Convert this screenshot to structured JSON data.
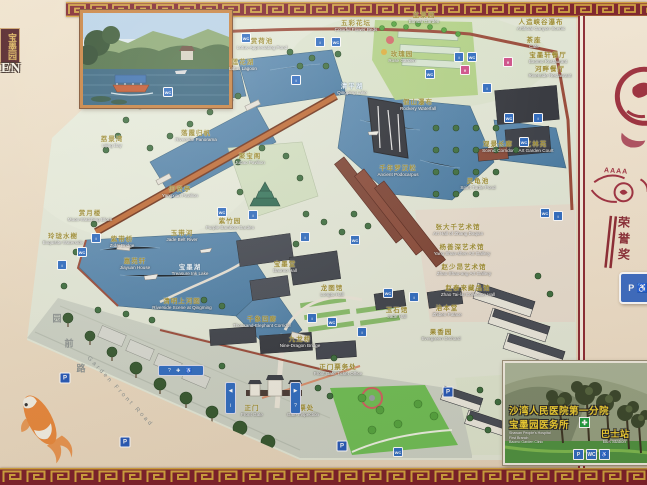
{
  "plaque": {
    "chars": "宝墨园",
    "latin": "EN"
  },
  "side_panel": {
    "stars": "AAAA",
    "vertical_chars": [
      "荣",
      "誉",
      "奖"
    ],
    "sign_glyphs": "P ♿"
  },
  "road": {
    "chars": [
      "园",
      "前",
      "路"
    ],
    "en": "Garden Front Road"
  },
  "colors": {
    "frame": "#7d1f28",
    "pattern_gold": "#d2a23c",
    "water": "#4f81a9",
    "mat": "#eedfc9",
    "accent_blue": "#2e6cc2"
  },
  "labels": [
    {
      "x": 262,
      "y": 45,
      "zh": "赏荷池",
      "en": "Lotus-Appreciating Pond"
    },
    {
      "x": 243,
      "y": 66,
      "zh": "莲花湖",
      "en": "Lotus Lagoon"
    },
    {
      "x": 356,
      "y": 27,
      "zh": "五彩花坛",
      "en": "Colorful Flower Beds"
    },
    {
      "x": 424,
      "y": 19,
      "zh": "盆景园",
      "en": "Bonsai Garden"
    },
    {
      "x": 541,
      "y": 26,
      "zh": "人造峡谷瀑布",
      "en": "Artificial Canyon Scenic"
    },
    {
      "x": 534,
      "y": 44,
      "zh": "茶座",
      "en": "Cafe"
    },
    {
      "x": 548,
      "y": 59,
      "zh": "宝墨轩餐厅",
      "en": "Baomo Restaurant"
    },
    {
      "x": 550,
      "y": 73,
      "zh": "河畔餐厅",
      "en": "Riverside Restaurant"
    },
    {
      "x": 402,
      "y": 58,
      "zh": "玫瑰园",
      "en": "Rose Garden"
    },
    {
      "x": 352,
      "y": 90,
      "zh": "清平湖",
      "en": "Qingping Lake",
      "w": 1
    },
    {
      "x": 112,
      "y": 143,
      "zh": "荔景湾",
      "en": "Lijing Bay"
    },
    {
      "x": 196,
      "y": 137,
      "zh": "落霞归帆",
      "en": "Riverside Panorama"
    },
    {
      "x": 180,
      "y": 193,
      "zh": "仰贤亭",
      "en": "Yangxian Pavilion"
    },
    {
      "x": 90,
      "y": 217,
      "zh": "赏月楼",
      "en": "Moon-Watching Block"
    },
    {
      "x": 63,
      "y": 240,
      "zh": "玲珑水榭",
      "en": "Exquisite Waterside"
    },
    {
      "x": 122,
      "y": 243,
      "zh": "紫带桥",
      "en": "Zidai Bridge"
    },
    {
      "x": 182,
      "y": 237,
      "zh": "玉带河",
      "en": "Jade Belt River"
    },
    {
      "x": 135,
      "y": 265,
      "zh": "嘉苑轩",
      "en": "Jiayuan House"
    },
    {
      "x": 190,
      "y": 271,
      "zh": "宝墨湖",
      "en": "Treasure Ink Lake",
      "w": 1
    },
    {
      "x": 182,
      "y": 305,
      "zh": "清明上河图",
      "en": "Riverside Scene at Qingming"
    },
    {
      "x": 230,
      "y": 225,
      "zh": "紫竹园",
      "en": "Purple Bamboo Garden"
    },
    {
      "x": 285,
      "y": 268,
      "zh": "宝墨堂",
      "en": "Baomo Hall"
    },
    {
      "x": 332,
      "y": 292,
      "zh": "龙图馆",
      "en": "Longtu Hall"
    },
    {
      "x": 262,
      "y": 323,
      "zh": "千象回廊",
      "en": "Thousand-Elephant Corridor"
    },
    {
      "x": 300,
      "y": 343,
      "zh": "九龙桥",
      "en": "Nine-Dragon Bridge"
    },
    {
      "x": 250,
      "y": 160,
      "zh": "聚宝阁",
      "en": "Jubao Pavilion"
    },
    {
      "x": 398,
      "y": 172,
      "zh": "千年罗汉松",
      "en": "Ancient Podocarpus"
    },
    {
      "x": 418,
      "y": 106,
      "zh": "假山瀑布",
      "en": "Rockery Waterfall"
    },
    {
      "x": 498,
      "y": 148,
      "zh": "观景长廊",
      "en": "Scenic Corridor"
    },
    {
      "x": 478,
      "y": 185,
      "zh": "灵龟池",
      "en": "Spirit Turtle Pond"
    },
    {
      "x": 536,
      "y": 148,
      "zh": "艺林苑",
      "en": "Art Garden Court"
    },
    {
      "x": 458,
      "y": 231,
      "zh": "张大千艺术馆",
      "en": "Art Hall of Zhang Daqian"
    },
    {
      "x": 462,
      "y": 251,
      "zh": "杨善深艺术馆",
      "en": "Yang Shan-shen Art Gallery"
    },
    {
      "x": 464,
      "y": 271,
      "zh": "赵少昂艺术馆",
      "en": "Zhao Shao-ang Art Gallery"
    },
    {
      "x": 468,
      "y": 292,
      "zh": "赵泰来藏品馆",
      "en": "Zhao Tai-lai Collection Hall"
    },
    {
      "x": 397,
      "y": 314,
      "zh": "玉石馆",
      "en": "Jade Hall"
    },
    {
      "x": 447,
      "y": 312,
      "zh": "治本堂",
      "en": "Zhiben Palace"
    },
    {
      "x": 441,
      "y": 336,
      "zh": "果香园",
      "en": "Evergreen Orchard"
    },
    {
      "x": 338,
      "y": 371,
      "zh": "正门票务处",
      "en": "Front Gate Ticket Office"
    },
    {
      "x": 252,
      "y": 412,
      "zh": "正门",
      "en": "Front Gate"
    },
    {
      "x": 303,
      "y": 412,
      "zh": "检票处",
      "en": "Gate Inspection"
    }
  ],
  "facility_icons": [
    {
      "x": 246,
      "y": 38,
      "g": "WC"
    },
    {
      "x": 320,
      "y": 42,
      "g": "i"
    },
    {
      "x": 336,
      "y": 42,
      "g": "WC"
    },
    {
      "x": 459,
      "y": 57,
      "g": "i"
    },
    {
      "x": 472,
      "y": 57,
      "g": "WC"
    },
    {
      "x": 465,
      "y": 70,
      "g": "¥",
      "c": "p"
    },
    {
      "x": 487,
      "y": 88,
      "g": "i"
    },
    {
      "x": 509,
      "y": 118,
      "g": "WC"
    },
    {
      "x": 538,
      "y": 118,
      "g": "i"
    },
    {
      "x": 524,
      "y": 142,
      "g": "WC"
    },
    {
      "x": 96,
      "y": 238,
      "g": "i"
    },
    {
      "x": 82,
      "y": 252,
      "g": "WC"
    },
    {
      "x": 62,
      "y": 265,
      "g": "i"
    },
    {
      "x": 222,
      "y": 212,
      "g": "WC"
    },
    {
      "x": 253,
      "y": 215,
      "g": "i"
    },
    {
      "x": 305,
      "y": 237,
      "g": "i"
    },
    {
      "x": 355,
      "y": 240,
      "g": "WC"
    },
    {
      "x": 388,
      "y": 293,
      "g": "WC"
    },
    {
      "x": 414,
      "y": 297,
      "g": "i"
    },
    {
      "x": 312,
      "y": 318,
      "g": "i"
    },
    {
      "x": 332,
      "y": 322,
      "g": "WC"
    },
    {
      "x": 362,
      "y": 332,
      "g": "i"
    },
    {
      "x": 545,
      "y": 213,
      "g": "WC"
    },
    {
      "x": 558,
      "y": 216,
      "g": "i"
    },
    {
      "x": 398,
      "y": 452,
      "g": "WC"
    },
    {
      "x": 168,
      "y": 92,
      "g": "WC"
    },
    {
      "x": 296,
      "y": 80,
      "g": "i"
    },
    {
      "x": 430,
      "y": 74,
      "g": "WC"
    },
    {
      "x": 508,
      "y": 62,
      "g": "¥",
      "c": "p"
    }
  ],
  "parking": [
    {
      "x": 65,
      "y": 378
    },
    {
      "x": 125,
      "y": 442
    },
    {
      "x": 342,
      "y": 446
    },
    {
      "x": 448,
      "y": 392
    }
  ],
  "service_bar": "? ✚ ♿",
  "gate_bars": [
    {
      "x": 225,
      "y": 382,
      "g1": "◀",
      "g2": "i"
    },
    {
      "x": 290,
      "y": 382,
      "g1": "▶",
      "g2": "?"
    }
  ],
  "clinic_inset": {
    "line1_zh": "沙湾人民医院第一分院",
    "line2_zh": "宝墨园医务所",
    "cross": "✚",
    "small_lines": [
      "Shawan People's Hospital",
      "First Branch",
      "Baomo Garden Clinic"
    ],
    "bus_zh": "巴士站",
    "bus_en": "Bus Station",
    "icons": [
      "P",
      "WC",
      "♿"
    ]
  }
}
